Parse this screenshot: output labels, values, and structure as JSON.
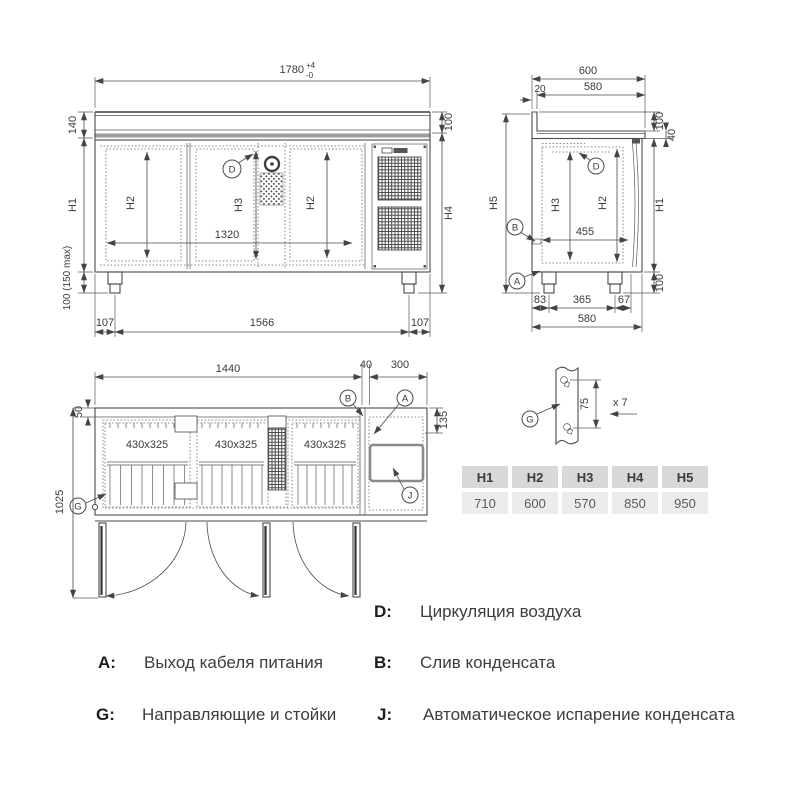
{
  "front_view": {
    "width_total": "1780",
    "tol_plus": "+4",
    "tol_minus": "-0",
    "top_height": "140",
    "body_height": "H1",
    "leg_height": "100 (150 max)",
    "leg_offset_left": "107",
    "leg_span": "1566",
    "leg_offset_right": "107",
    "door_height_left": "H2",
    "center_height": "H3",
    "door_height_right": "H2",
    "inner_width": "1320",
    "top_right_height": "100",
    "overall_height": "H4",
    "marker_air": "D"
  },
  "side_view": {
    "depth_total": "600",
    "backsplash_thickness": "20",
    "depth_top": "580",
    "backsplash_height": "100",
    "worktop_thickness": "40",
    "overall_height": "H5",
    "inner_height": "H3",
    "door_height": "H2",
    "body_height": "H1",
    "inner_depth": "455",
    "leg_front_offset": "83",
    "leg_span": "365",
    "leg_back_offset": "67",
    "depth_bottom": "580",
    "leg_height": "100",
    "marker_air": "D",
    "marker_drain": "B",
    "marker_cable": "A"
  },
  "top_view": {
    "inner_width": "1440",
    "divider_width": "40",
    "unit_width": "300",
    "back_offset": "50",
    "depth_open": "1025",
    "side_offset": "135",
    "grid_size": "430x325",
    "marker_drain": "B",
    "marker_cable": "A",
    "marker_evaporation": "J",
    "marker_rails": "G"
  },
  "bracket_detail": {
    "pitch": "75",
    "quantity": "x 7",
    "marker_rails": "G"
  },
  "size_table": {
    "headers": [
      "H1",
      "H2",
      "H3",
      "H4",
      "H5"
    ],
    "values": [
      "710",
      "600",
      "570",
      "850",
      "950"
    ]
  },
  "legend": {
    "a": {
      "key": "A:",
      "text": "Выход кабеля питания"
    },
    "b": {
      "key": "B:",
      "text": "Слив конденсата"
    },
    "d": {
      "key": "D:",
      "text": "Циркуляция воздуха"
    },
    "g": {
      "key": "G:",
      "text": "Направляющие и стойки"
    },
    "j": {
      "key": "J:",
      "text": "Автоматическое испарение конденсата"
    }
  }
}
